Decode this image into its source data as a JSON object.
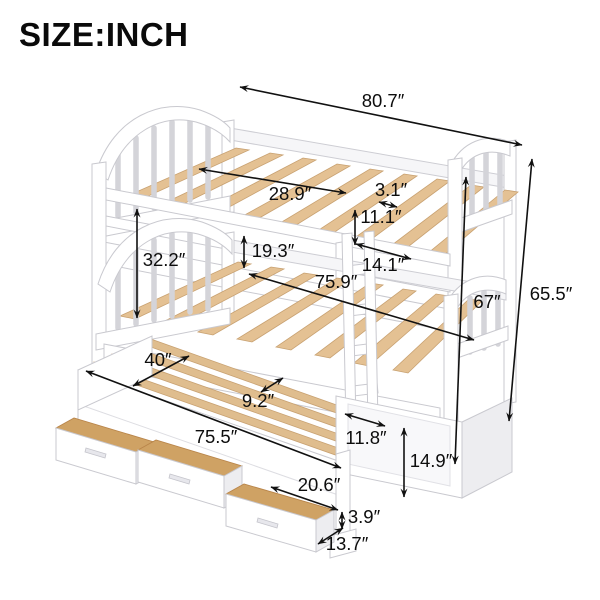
{
  "title": "SIZE:INCH",
  "colors": {
    "text": "#0d0d0d",
    "bed_white": "#ffffff",
    "outline": "#c9c9cf",
    "slat_wood": "#e4c193",
    "drawer_wood": "#cfa264"
  },
  "dims": {
    "total_length": "80.7″",
    "guardrail_opening": "28.9″",
    "rail_gap": "3.1″",
    "guardrail_height": "11.1″",
    "bunk_clearance": "19.3″",
    "upper_section_height": "32.2″",
    "foot_section_width": "14.1″",
    "lower_bed_length": "75.9″",
    "front_height": "67″",
    "total_height": "65.5″",
    "trundle_width": "40″",
    "slat_spacing": "9.2″",
    "trundle_length": "75.5″",
    "ladder_width": "11.8″",
    "trundle_height": "14.9″",
    "drawer_width": "20.6″",
    "drawer_height": "3.9″",
    "drawer_depth": "13.7″"
  }
}
